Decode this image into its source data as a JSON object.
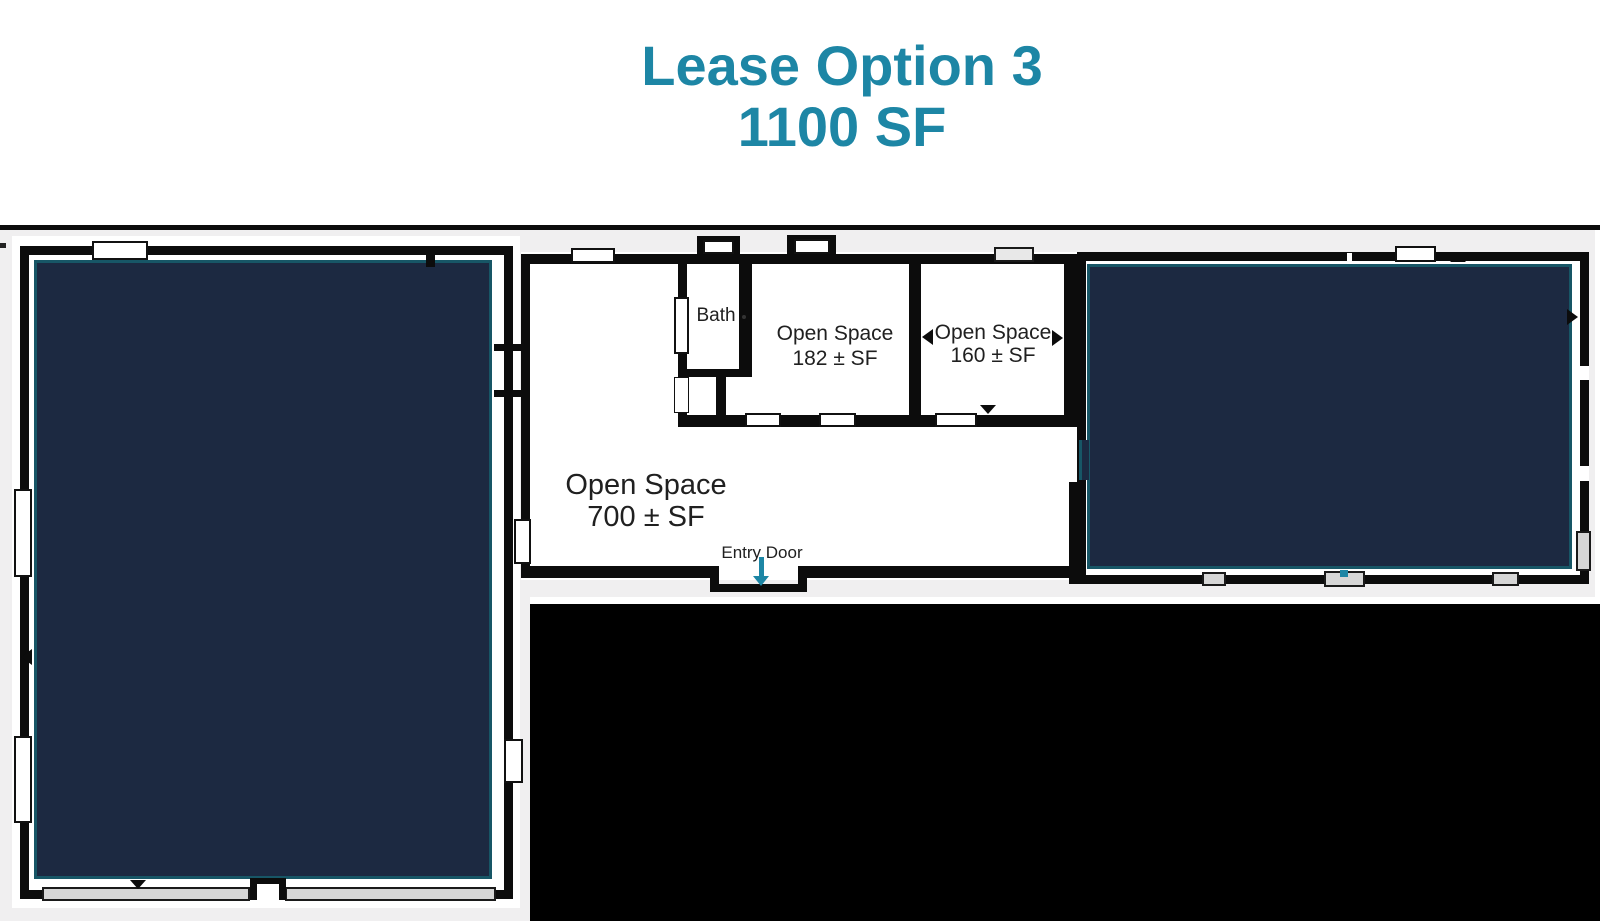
{
  "title": {
    "line1": "Lease Option 3",
    "line2": "1100 SF"
  },
  "floorplan": {
    "bath_label": "Bath",
    "rooms": [
      {
        "name": "open-space-182",
        "line1": "Open Space",
        "line2": "182 ± SF"
      },
      {
        "name": "open-space-160",
        "line1": "Open Space",
        "line2": "160 ± SF"
      },
      {
        "name": "open-space-700",
        "line1": "Open Space",
        "line2": "700 ± SF"
      }
    ],
    "entry_label": "Entry Door"
  },
  "colors": {
    "accent_teal": "#1d86a5",
    "leased_area_navy": "#1c2941",
    "leased_area_edge": "#175666",
    "wall_black": "#0c0c0c",
    "backdrop_gray": "#f0eff0",
    "window_bar_gray": "#d6d6d6",
    "masked_region_black": "#000000"
  },
  "icons": {
    "entry_door_arrow": "down-arrow",
    "door_markers": "small-triangle-door-swing-indicators"
  }
}
